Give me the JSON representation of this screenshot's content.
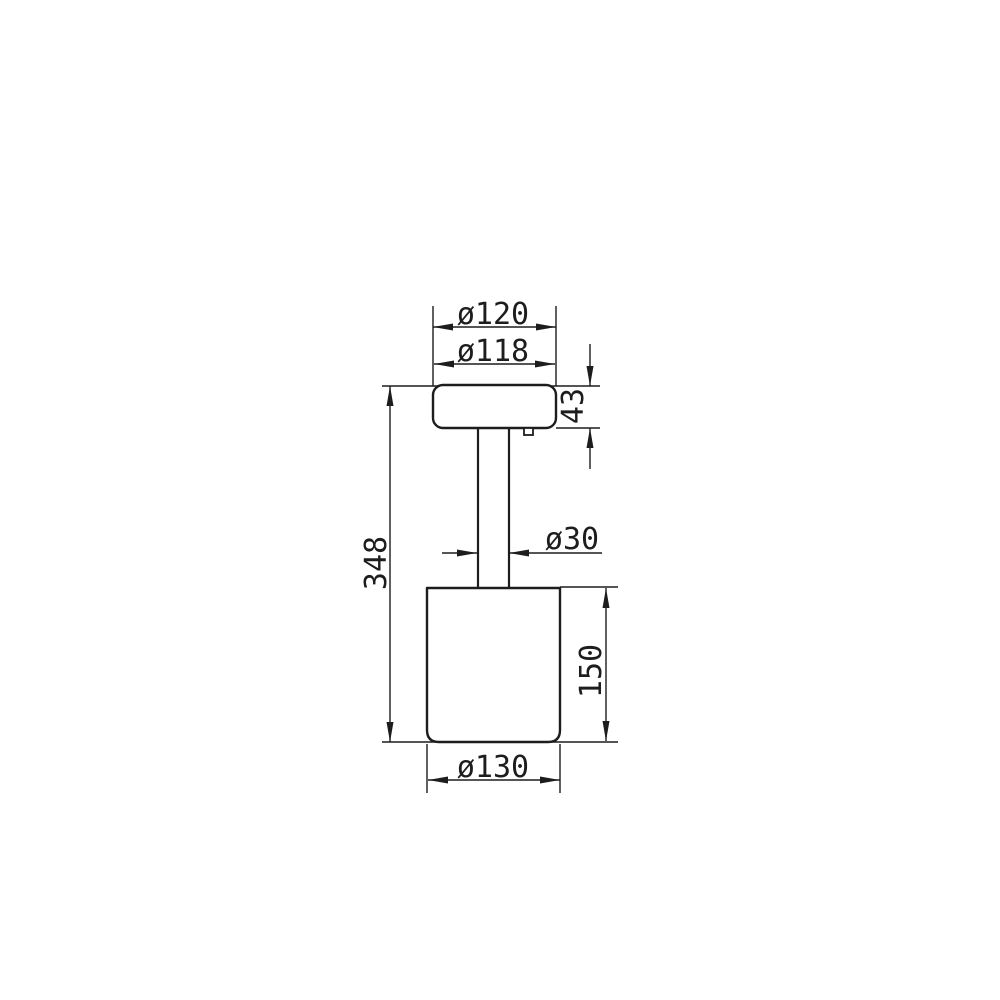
{
  "drawing": {
    "background_color": "#ffffff",
    "line_color": "#1d1d1d",
    "labels": {
      "head_outer_diameter": "ø120",
      "head_top_diameter": "ø118",
      "head_height": "43",
      "stem_diameter": "ø30",
      "overall_height": "348",
      "body_height": "150",
      "body_diameter": "ø130"
    }
  }
}
